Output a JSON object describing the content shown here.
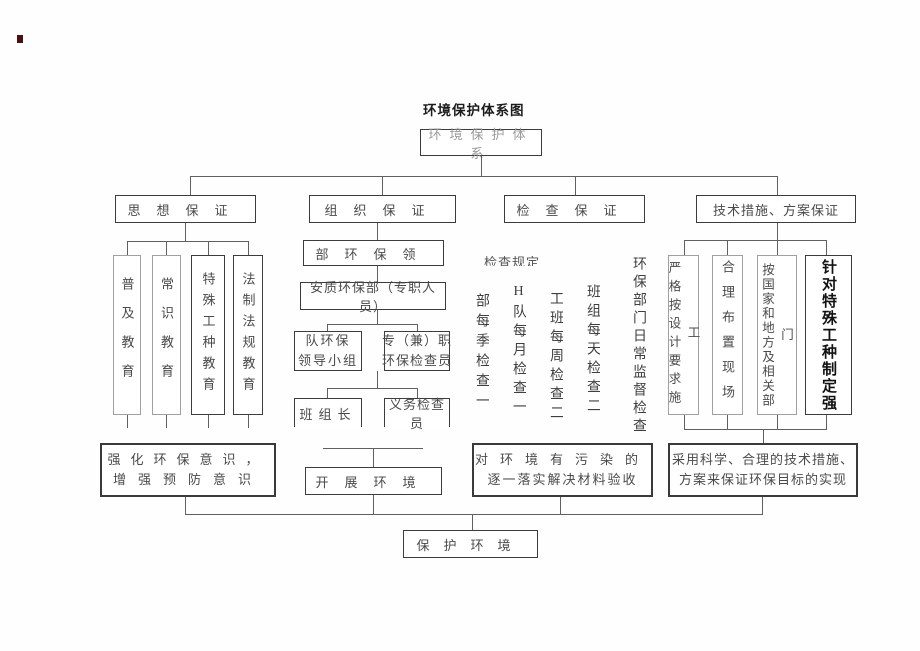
{
  "page": {
    "title": "环境保护体系图"
  },
  "root": {
    "label": "环境保护体系"
  },
  "branches": {
    "thought": {
      "label": "思想保证"
    },
    "organization": {
      "label": "组织保证"
    },
    "inspection": {
      "label": "检查保证"
    },
    "technical": {
      "label": "技术措施、方案保证"
    }
  },
  "thought": {
    "education": [
      "普及教育",
      "常识教育",
      "特殊工种教育",
      "法制法规教育"
    ],
    "outcome": {
      "line1": "强化环保意识，",
      "line2": "增强预防意识"
    }
  },
  "organization": {
    "level1": "部环保领",
    "level2": "安质环保部（专职人员）",
    "level3_left": {
      "line1": "队环保",
      "line2": "领导小组"
    },
    "level3_right": {
      "line1": "专（兼）职",
      "line2": "环保检查员"
    },
    "level4_left": "班组长",
    "level4_right": "义务检查员",
    "outcome": "开展环境"
  },
  "inspection": {
    "clipped_header": "检查规定",
    "schedule": [
      "部每季检查一次",
      "H队每月检查一次",
      "工班每周检查二次",
      "班组每天检查二次",
      "环保部门日常监督检查"
    ],
    "outcome": {
      "line1": "对环境有污染的",
      "line2": "逐一落实解决材料验收"
    }
  },
  "technical": {
    "measures": [
      "严格按设计要求施工",
      "合理布置现场",
      "按国家和地方及相关部门",
      "针对特殊工种制定强"
    ],
    "outcome": {
      "line1": "采用科学、合理的技术措施、",
      "line2": "方案来保证环保目标的实现"
    }
  },
  "goal": {
    "label": "保护环境"
  },
  "colors": {
    "border_dark": "#3c3c3c",
    "border_light": "#a0a0a0",
    "line": "#606060",
    "text": "#444444",
    "muted_text": "#9a9a9a"
  }
}
